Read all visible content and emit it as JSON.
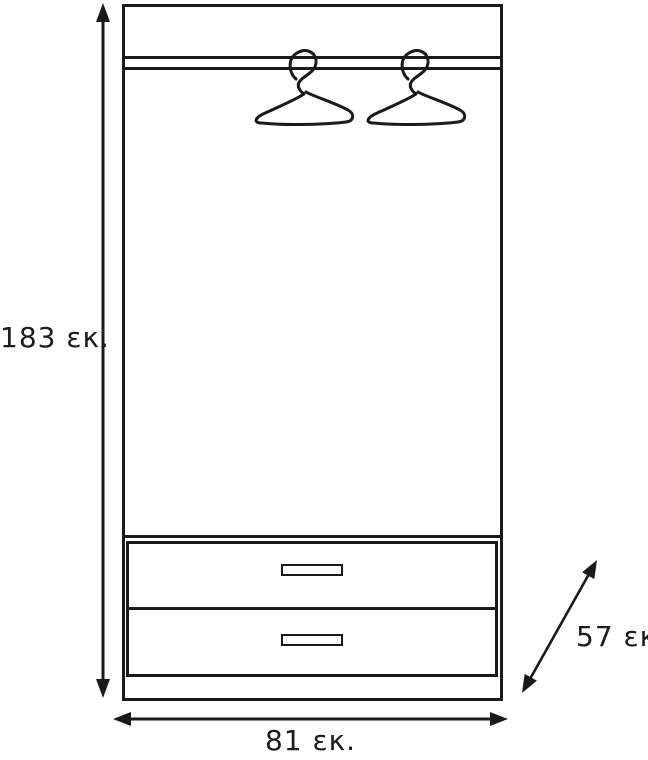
{
  "diagram": {
    "subject": "wardrobe-dimension-drawing",
    "colors": {
      "line": "#1a1a1a",
      "background": "#ffffff"
    },
    "dimensions": {
      "height": {
        "value": 183,
        "unit": "εκ.",
        "label": "183 εκ."
      },
      "width": {
        "value": 81,
        "unit": "εκ.",
        "label": "81 εκ."
      },
      "depth": {
        "value": 57,
        "unit": "εκ.",
        "label": "57 εκ."
      }
    },
    "parts": {
      "hanger_count": 2,
      "drawer_count": 2
    }
  }
}
